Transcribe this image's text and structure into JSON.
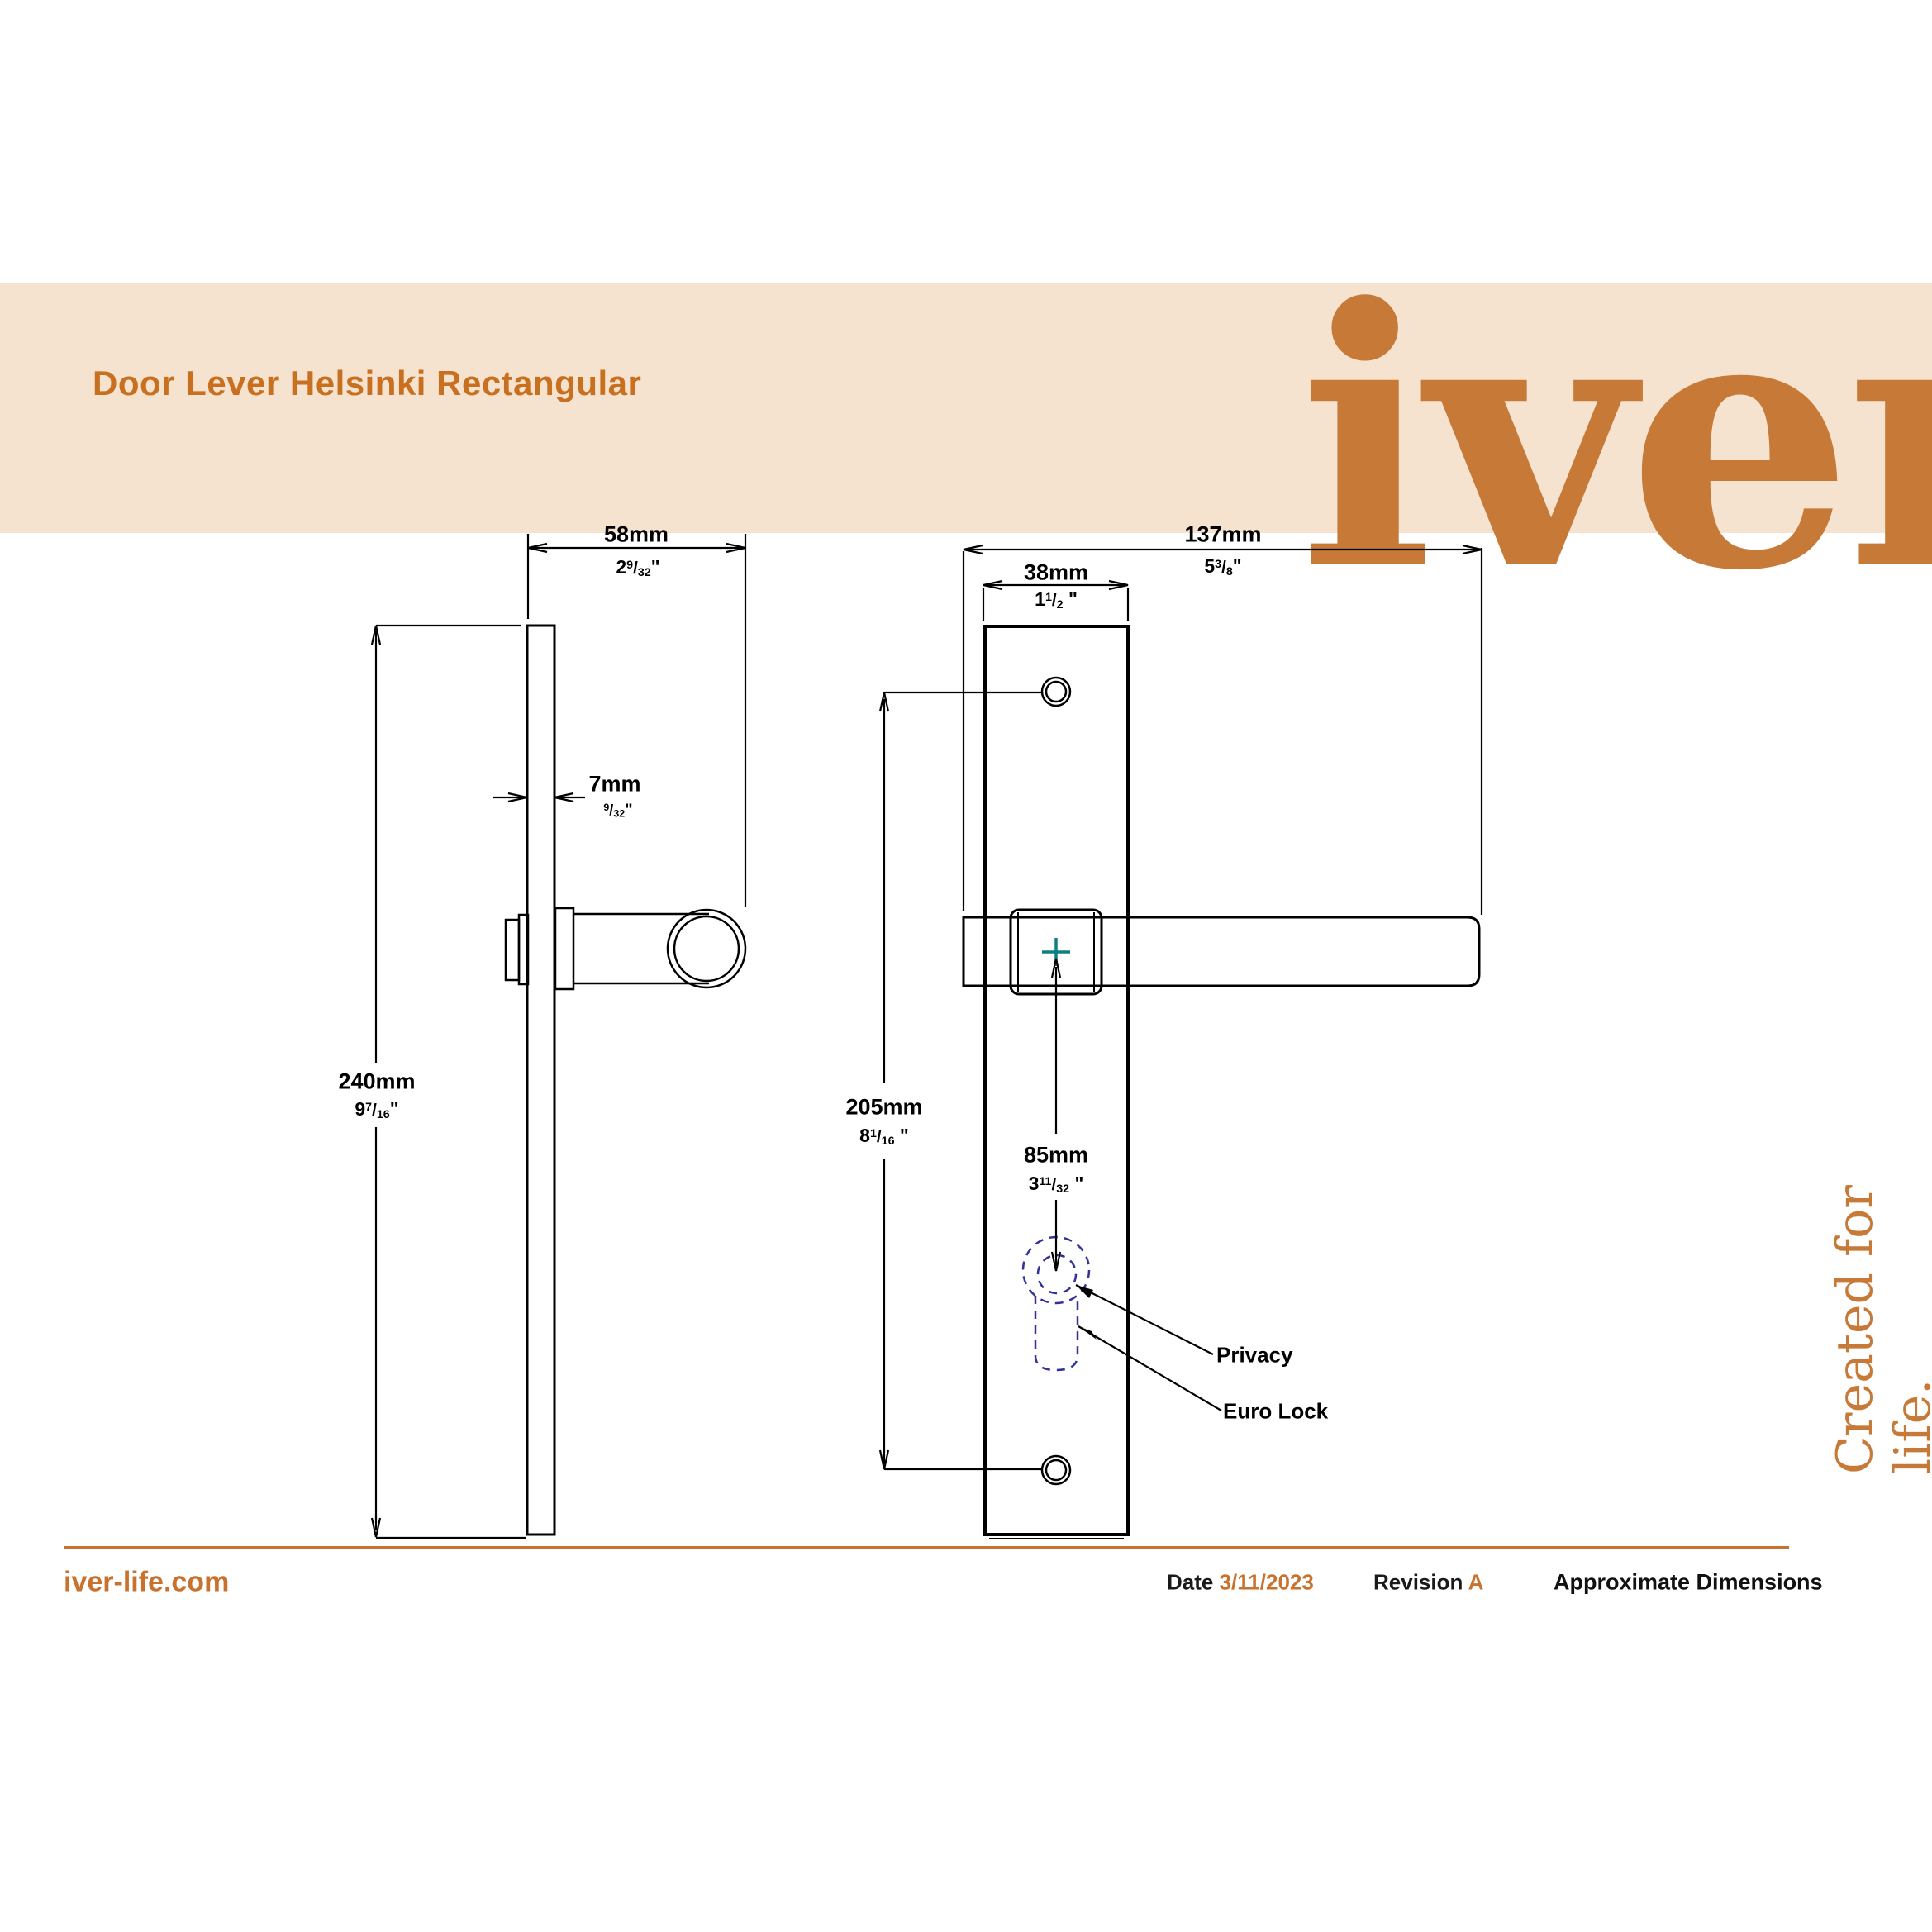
{
  "header": {
    "title": "Door Lever Helsinki Rectangular",
    "logo": "iver"
  },
  "tagline": "Created for life.",
  "glyphs": {
    "slash": "/"
  },
  "dimensions": {
    "projection": {
      "mm": "58mm",
      "in_whole": "2",
      "in_num": "9",
      "in_den": "32",
      "quote": "\""
    },
    "thickness": {
      "mm": "7mm",
      "in_whole": "",
      "in_num": "9",
      "in_den": "32",
      "quote": "\""
    },
    "plate_height": {
      "mm": "240mm",
      "in_whole": "9",
      "in_num": "7",
      "in_den": "16",
      "quote": "\""
    },
    "lever_length": {
      "mm": "137mm",
      "in_whole": "5",
      "in_num": "3",
      "in_den": "8",
      "quote": "\""
    },
    "plate_width": {
      "mm": "38mm",
      "in_whole": "1",
      "in_num": "1",
      "in_den": "2",
      "quote": " \""
    },
    "hole_centres": {
      "mm": "205mm",
      "in_whole": "8",
      "in_num": "1",
      "in_den": "16",
      "quote": " \""
    },
    "cylinder_centre": {
      "mm": "85mm",
      "in_whole": "3",
      "in_num": "11",
      "in_den": "32",
      "quote": " \""
    }
  },
  "callouts": {
    "privacy": "Privacy",
    "euro_lock": "Euro Lock"
  },
  "footer": {
    "site": "iver-life.com",
    "date_label": "Date",
    "date_value": "3/11/2023",
    "revision_label": "Revision",
    "revision_value": "A",
    "note": "Approximate Dimensions"
  },
  "colors": {
    "accent_orange": "#c8722e",
    "band_peach": "#f5e2cf",
    "keyhole_dash_blue": "#32329a",
    "centre_cross_teal": "#0f7f7f",
    "line_black": "#000000"
  }
}
